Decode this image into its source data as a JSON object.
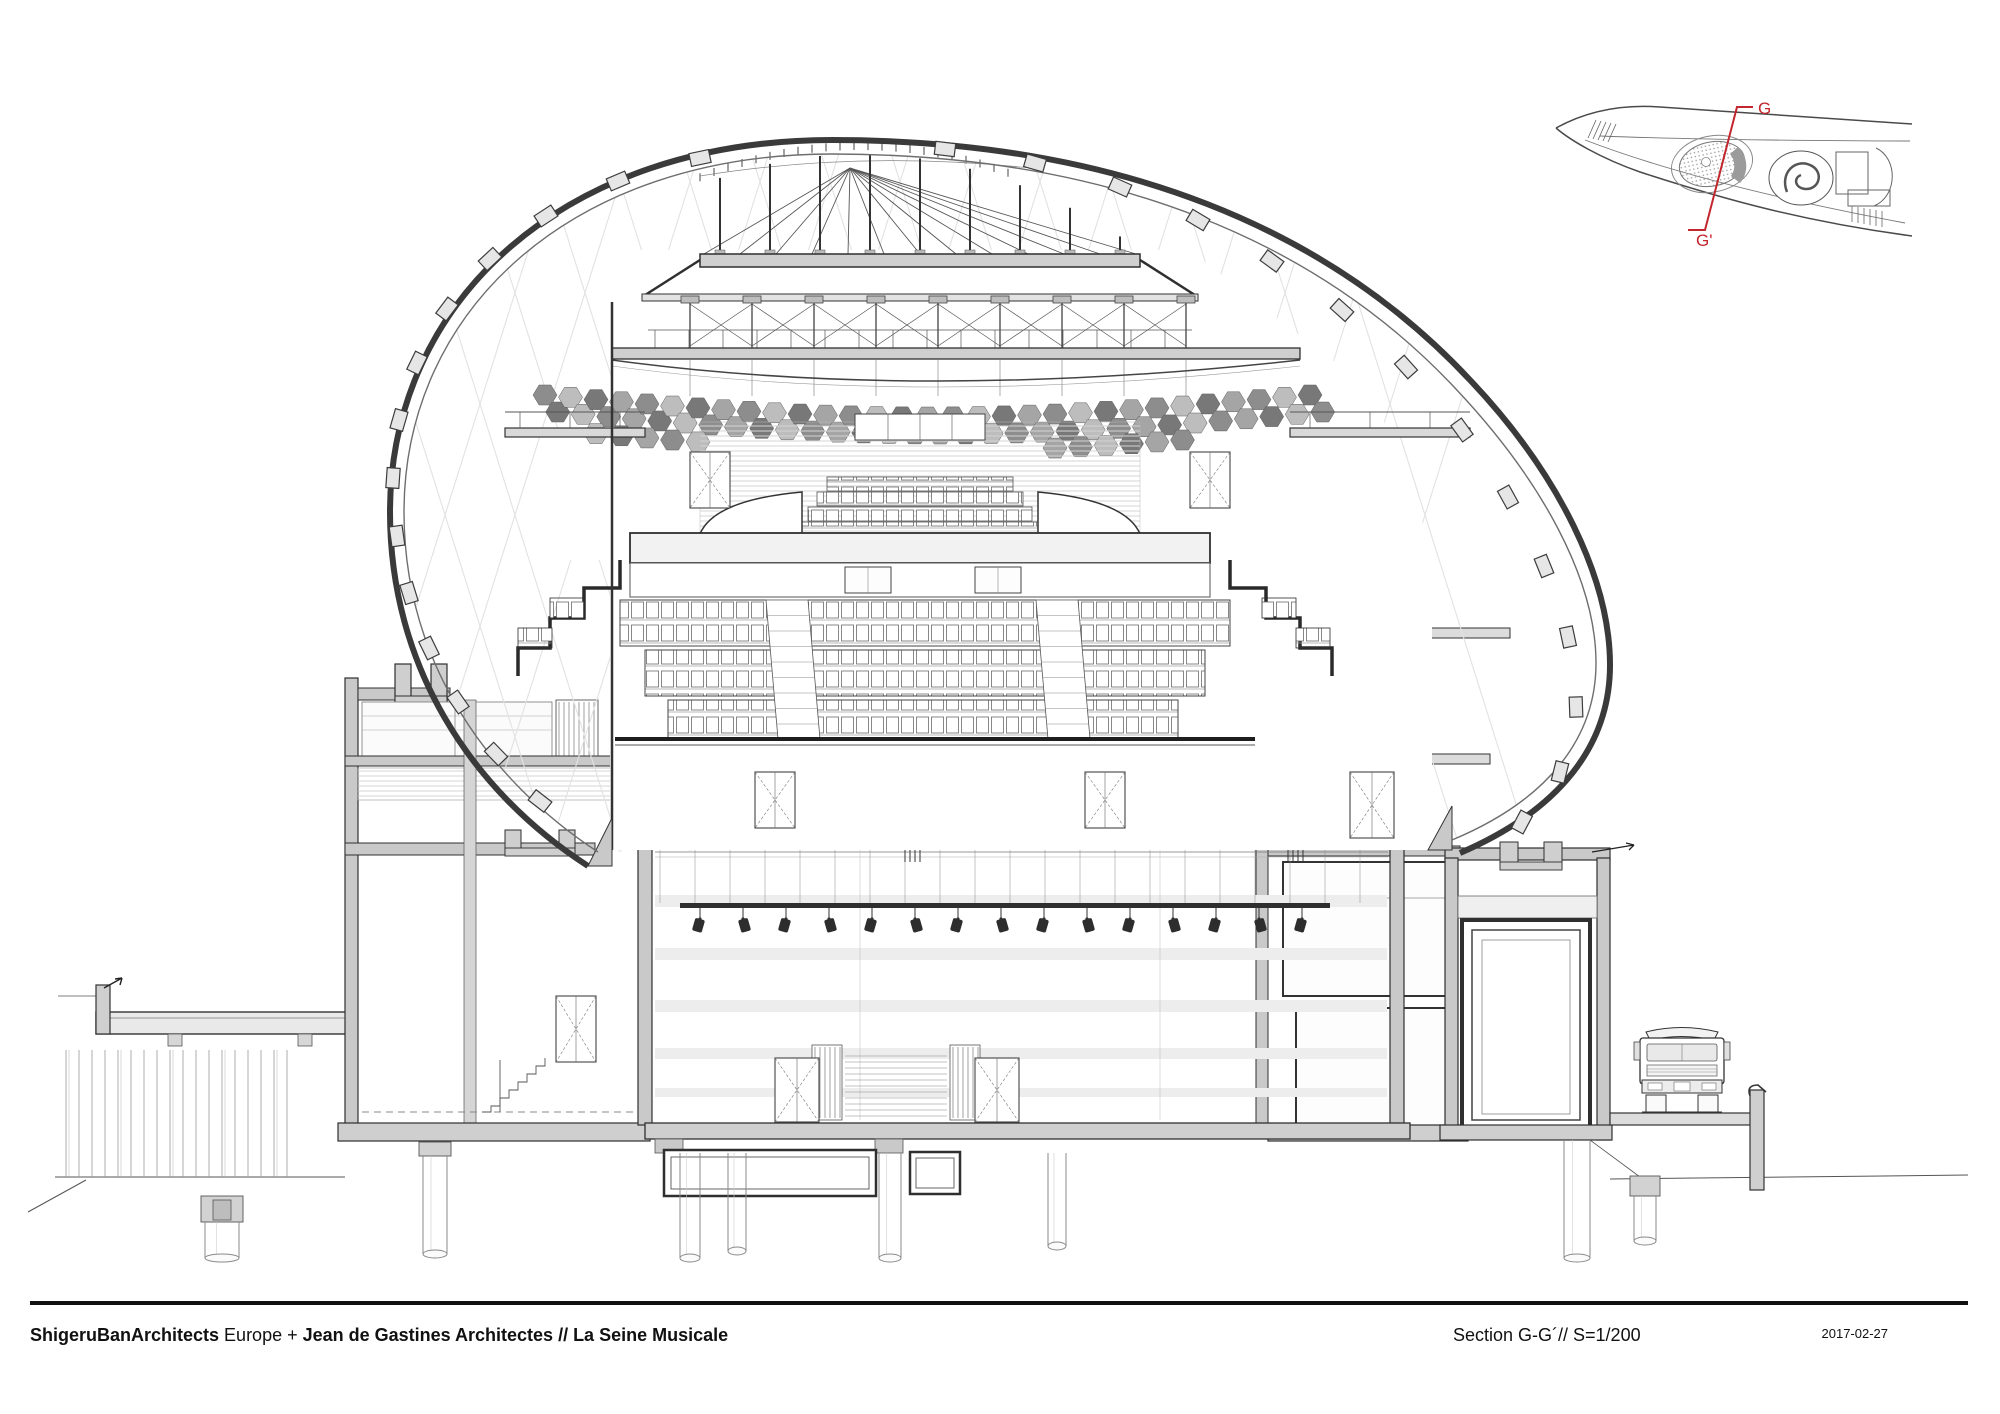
{
  "title_block": {
    "firm": "ShigeruBanArchitects",
    "firm_suffix": " Europe + ",
    "partner": "Jean de Gastines Architectes",
    "project": " // La Seine Musicale",
    "drawing_title": "Section G-G´// S=1/200",
    "date": "2017-02-27"
  },
  "key_plan": {
    "section_start": "G",
    "section_end": "G'"
  },
  "colors": {
    "accent_red": "#c2272d",
    "line": "#2f2f2f",
    "poche_gray": "#c9c9c9",
    "faint_lattice": "#e2e2e2",
    "hex_grays": [
      "#8d8d8d",
      "#a5a5a5",
      "#787878",
      "#bdbdbd"
    ]
  }
}
